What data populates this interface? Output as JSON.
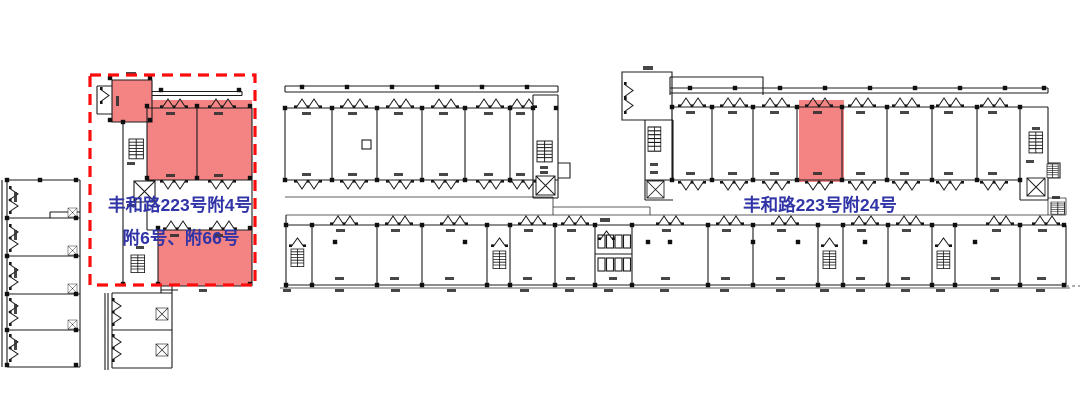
{
  "drawing": {
    "kind": "architectural floor plan (CAD site/leasing plan)",
    "background": "#ffffff"
  },
  "labels": {
    "left_unit_line1": "丰和路223号附4号",
    "left_unit_line2": "附6号、附66号",
    "right_unit": "丰和路223号附24号"
  },
  "colors": {
    "highlight_fill": "#F48484",
    "selection_box": "#FB0D0D",
    "label_text": "#3134A6",
    "line": "#1B1B1B"
  }
}
